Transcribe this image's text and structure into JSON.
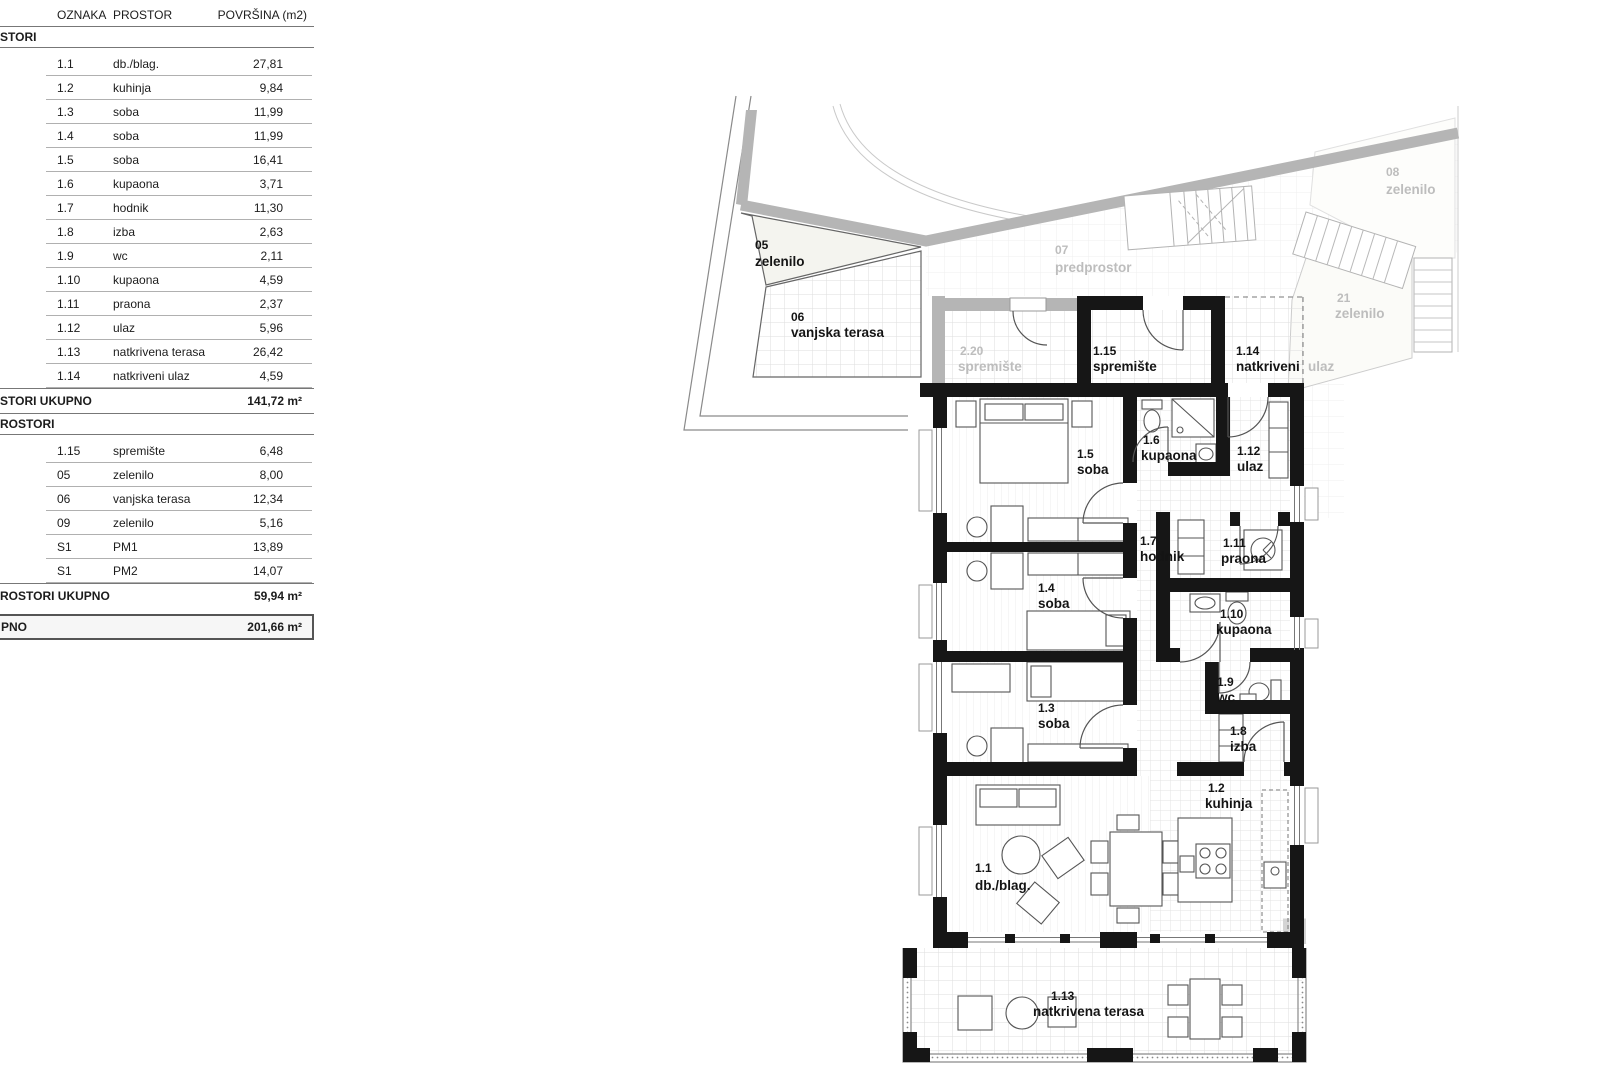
{
  "table": {
    "headers": {
      "oznaka": "OZNAKA",
      "prostor": "PROSTOR",
      "povrsina": "POVRŠINA (m2)"
    },
    "closed_section": {
      "title_fragment": "STORI",
      "rows": [
        {
          "oznaka": "1.1",
          "prostor": "db./blag.",
          "povrsina": "27,81"
        },
        {
          "oznaka": "1.2",
          "prostor": "kuhinja",
          "povrsina": "9,84"
        },
        {
          "oznaka": "1.3",
          "prostor": "soba",
          "povrsina": "11,99"
        },
        {
          "oznaka": "1.4",
          "prostor": "soba",
          "povrsina": "11,99"
        },
        {
          "oznaka": "1.5",
          "prostor": "soba",
          "povrsina": "16,41"
        },
        {
          "oznaka": "1.6",
          "prostor": "kupaona",
          "povrsina": "3,71"
        },
        {
          "oznaka": "1.7",
          "prostor": "hodnik",
          "povrsina": "11,30"
        },
        {
          "oznaka": "1.8",
          "prostor": "izba",
          "povrsina": "2,63"
        },
        {
          "oznaka": "1.9",
          "prostor": "wc",
          "povrsina": "2,11"
        },
        {
          "oznaka": "1.10",
          "prostor": "kupaona",
          "povrsina": "4,59"
        },
        {
          "oznaka": "1.11",
          "prostor": "praona",
          "povrsina": "2,37"
        },
        {
          "oznaka": "1.12",
          "prostor": "ulaz",
          "povrsina": "5,96"
        },
        {
          "oznaka": "1.13",
          "prostor": "natkrivena terasa",
          "povrsina": "26,42"
        },
        {
          "oznaka": "1.14",
          "prostor": "natkriveni ulaz",
          "povrsina": "4,59"
        }
      ],
      "total_label_fragment": "STORI UKUPNO",
      "total_value": "141,72 m²"
    },
    "open_section": {
      "title_fragment": "ROSTORI",
      "rows": [
        {
          "oznaka": "1.15",
          "prostor": "spremište",
          "povrsina": "6,48"
        },
        {
          "oznaka": "05",
          "prostor": "zelenilo",
          "povrsina": "8,00"
        },
        {
          "oznaka": "06",
          "prostor": "vanjska terasa",
          "povrsina": "12,34"
        },
        {
          "oznaka": "09",
          "prostor": "zelenilo",
          "povrsina": "5,16"
        },
        {
          "oznaka": "S1",
          "prostor": "PM1",
          "povrsina": "13,89"
        },
        {
          "oznaka": "S1",
          "prostor": "PM2",
          "povrsina": "14,07"
        }
      ],
      "total_label_fragment": "ROSTORI UKUPNO",
      "total_value": "59,94 m²"
    },
    "grand_total": {
      "label_fragment": "PNO",
      "value": "201,66 m²"
    }
  },
  "plan": {
    "rooms": {
      "r11": {
        "num": "1.1",
        "name": "db./blag."
      },
      "r12": {
        "num": "1.2",
        "name": "kuhinja"
      },
      "r13": {
        "num": "1.3",
        "name": "soba"
      },
      "r14": {
        "num": "1.4",
        "name": "soba"
      },
      "r15": {
        "num": "1.5",
        "name": "soba"
      },
      "r16": {
        "num": "1.6",
        "name": "kupaona"
      },
      "r17": {
        "num": "1.7",
        "name": "hodnik"
      },
      "r18": {
        "num": "1.8",
        "name": "izba"
      },
      "r19": {
        "num": "1.9",
        "name": "wc"
      },
      "r110": {
        "num": "1.10",
        "name": "kupaona"
      },
      "r111": {
        "num": "1.11",
        "name": "praona"
      },
      "r112": {
        "num": "1.12",
        "name": "ulaz"
      },
      "r113": {
        "num": "1.13",
        "name": "natkrivena terasa"
      },
      "r114": {
        "num": "1.14",
        "name": "natkriveni",
        "name2": "ulaz"
      },
      "r115": {
        "num": "1.15",
        "name": "spremište"
      }
    },
    "site": {
      "s05": {
        "num": "05",
        "name": "zelenilo"
      },
      "s06": {
        "num": "06",
        "name": "vanjska terasa"
      },
      "s07": {
        "num": "07",
        "name": "predprostor"
      },
      "s08": {
        "num": "08",
        "name": "zelenilo"
      },
      "s21": {
        "num": "21",
        "name": "zelenilo"
      },
      "s220": {
        "num": "2.20",
        "name": "spremište"
      }
    },
    "watermark": "u",
    "colors": {
      "wall": "#161616",
      "gray_wall": "#b5b5b5",
      "gray_label": "#bdbdbd"
    }
  }
}
